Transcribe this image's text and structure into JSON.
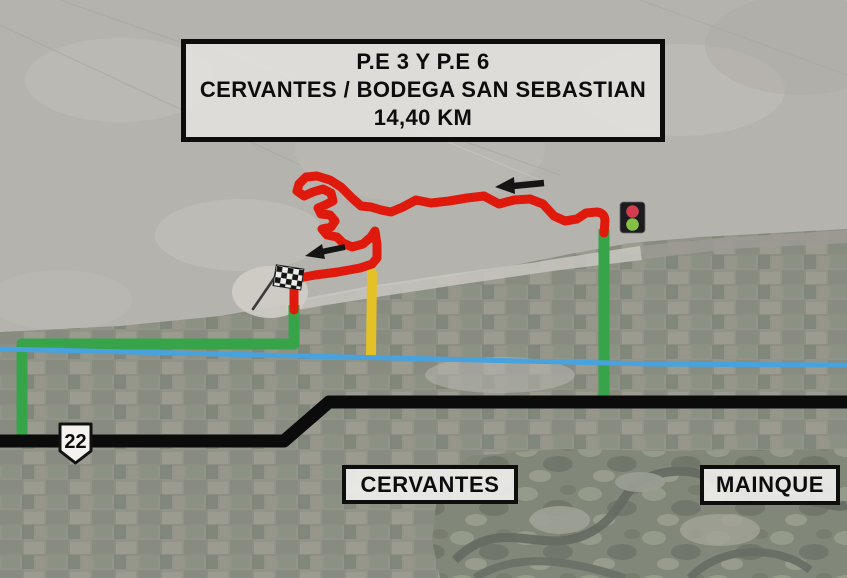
{
  "title_box": {
    "line1": "P.E 3 Y P.E 6",
    "line2": "CERVANTES / BODEGA SAN SEBASTIAN",
    "line3": "14,40 KM"
  },
  "towns": [
    {
      "name": "CERVANTES"
    },
    {
      "name": "MAINQUE"
    }
  ],
  "route_shield": {
    "number": "22"
  },
  "icons": [
    {
      "name": "traffic-light-icon"
    },
    {
      "name": "checkered-flag-icon"
    },
    {
      "name": "direction-arrow-icon"
    },
    {
      "name": "route-22-shield"
    }
  ],
  "colors": {
    "stage_route": "#df1a0c",
    "liaison_road": "#38a44a",
    "secondary_road": "#e4c127",
    "river": "#47a2dd",
    "highway": "#0b0b0b",
    "traffic_light_red": "#d63c50",
    "traffic_light_green": "#85c046",
    "arrow": "#151515"
  }
}
